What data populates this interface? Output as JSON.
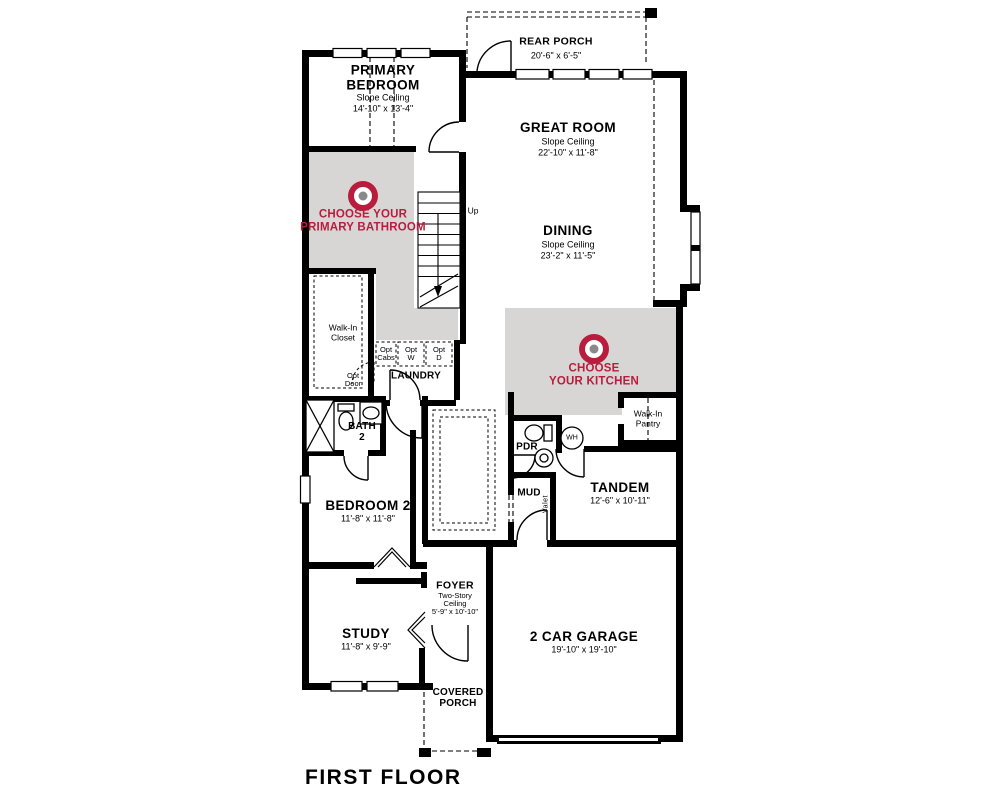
{
  "title": "FIRST FLOOR",
  "colors": {
    "wall": "#000000",
    "highlight_gray": "#d8d5d5",
    "accent_red": "#b81d3d",
    "target_center_gray": "#8a8a8a"
  },
  "rooms": {
    "rear_porch": {
      "name": "REAR PORCH",
      "dims": "20'-6\" x 6'-5\""
    },
    "primary_bedroom": {
      "name": "PRIMARY\nBEDROOM",
      "ceiling": "Slope Ceiling",
      "dims": "14'-10\" x 13'-4\""
    },
    "great_room": {
      "name": "GREAT ROOM",
      "ceiling": "Slope Ceiling",
      "dims": "22'-10\" x 11'-8\""
    },
    "dining": {
      "name": "DINING",
      "ceiling": "Slope Ceiling",
      "dims": "23'-2\" x 11'-5\""
    },
    "bedroom_2": {
      "name": "BEDROOM 2",
      "dims": "11'-8\" x 11'-8\""
    },
    "study": {
      "name": "STUDY",
      "dims": "11'-8\" x 9'-9\""
    },
    "foyer": {
      "name": "FOYER",
      "ceiling": "Two-Story\nCeiling",
      "dims": "5'-9\" x 10'-10\""
    },
    "tandem": {
      "name": "TANDEM",
      "dims": "12'-6\" x 10'-11\""
    },
    "garage": {
      "name": "2 CAR GARAGE",
      "dims": "19'-10\" x 19'-10\""
    },
    "covered_porch": {
      "name": "COVERED\nPORCH"
    },
    "laundry": {
      "name": "LAUNDRY"
    },
    "bath_2": {
      "name": "BATH\n2"
    },
    "walk_in_closet": {
      "name": "Walk-In\nCloset"
    },
    "walk_in_pantry": {
      "name": "Walk-In\nPantry"
    },
    "pdr": {
      "name": "PDR"
    },
    "mud": {
      "name": "MUD"
    },
    "wh": {
      "name": "WH"
    },
    "valet": {
      "name": "Valet"
    },
    "up": {
      "name": "Up"
    }
  },
  "options": {
    "primary_bathroom": {
      "label": "CHOOSE YOUR\nPRIMARY BATHROOM"
    },
    "kitchen": {
      "label": "CHOOSE\nYOUR KITCHEN"
    }
  },
  "opt_notes": {
    "opt_cabs": "Opt\nCabs",
    "opt_w": "Opt\nW",
    "opt_d": "Opt\nD",
    "opt_door": "Opt\nDoor"
  }
}
